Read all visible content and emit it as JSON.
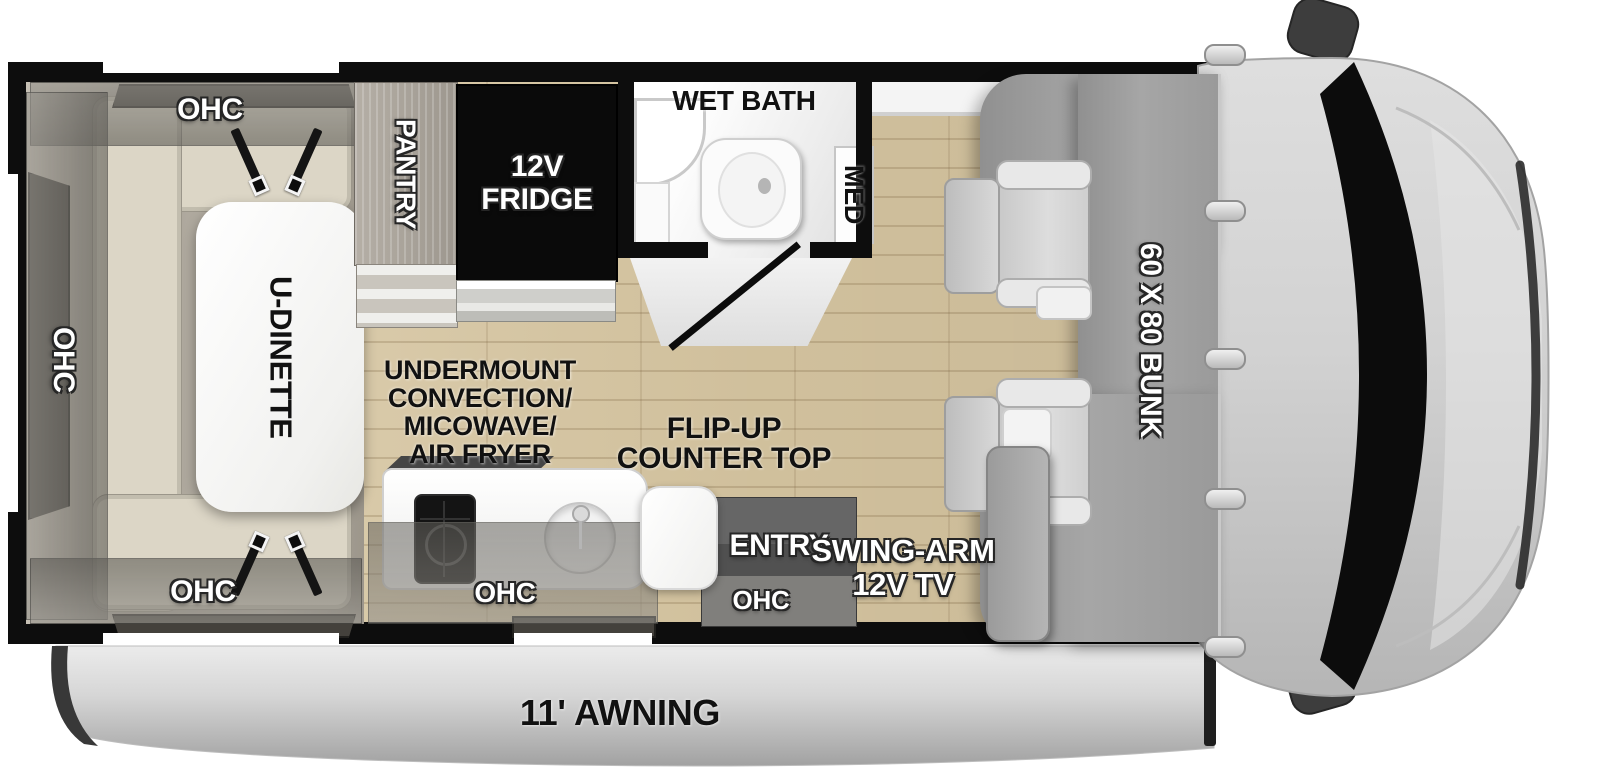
{
  "labels": {
    "ohc": "OHC",
    "pantry": "PANTRY",
    "fridge": [
      "12V",
      "FRIDGE"
    ],
    "wet_bath": "WET BATH",
    "med": "MED",
    "u_dinette": "U-DINETTE",
    "appliance": [
      "UNDERMOUNT",
      "CONVECTION/",
      "MICOWAVE/",
      "AIR FRYER"
    ],
    "flip_up": [
      "FLIP-UP",
      "COUNTER TOP"
    ],
    "entry": "ENTRY",
    "swing_tv": [
      "SWING-ARM",
      "12V TV"
    ],
    "bunk": "60 X 80 BUNK",
    "awning": "11' AWNING"
  },
  "colors": {
    "wall": "#0d0d0d",
    "floor_wood": "#d9c8a3",
    "cabinet_taupe": "#b4aea3",
    "cushion_beige": "#dcd6c6",
    "table_white": "#fdfdfd",
    "bunk_gray": "#9e9e9e",
    "cab_gray": "#d2d2d2",
    "entry_gray": "#515151",
    "awning_gray": "#c7c7c7",
    "label_white": "#ffffff",
    "label_black": "#111111"
  }
}
